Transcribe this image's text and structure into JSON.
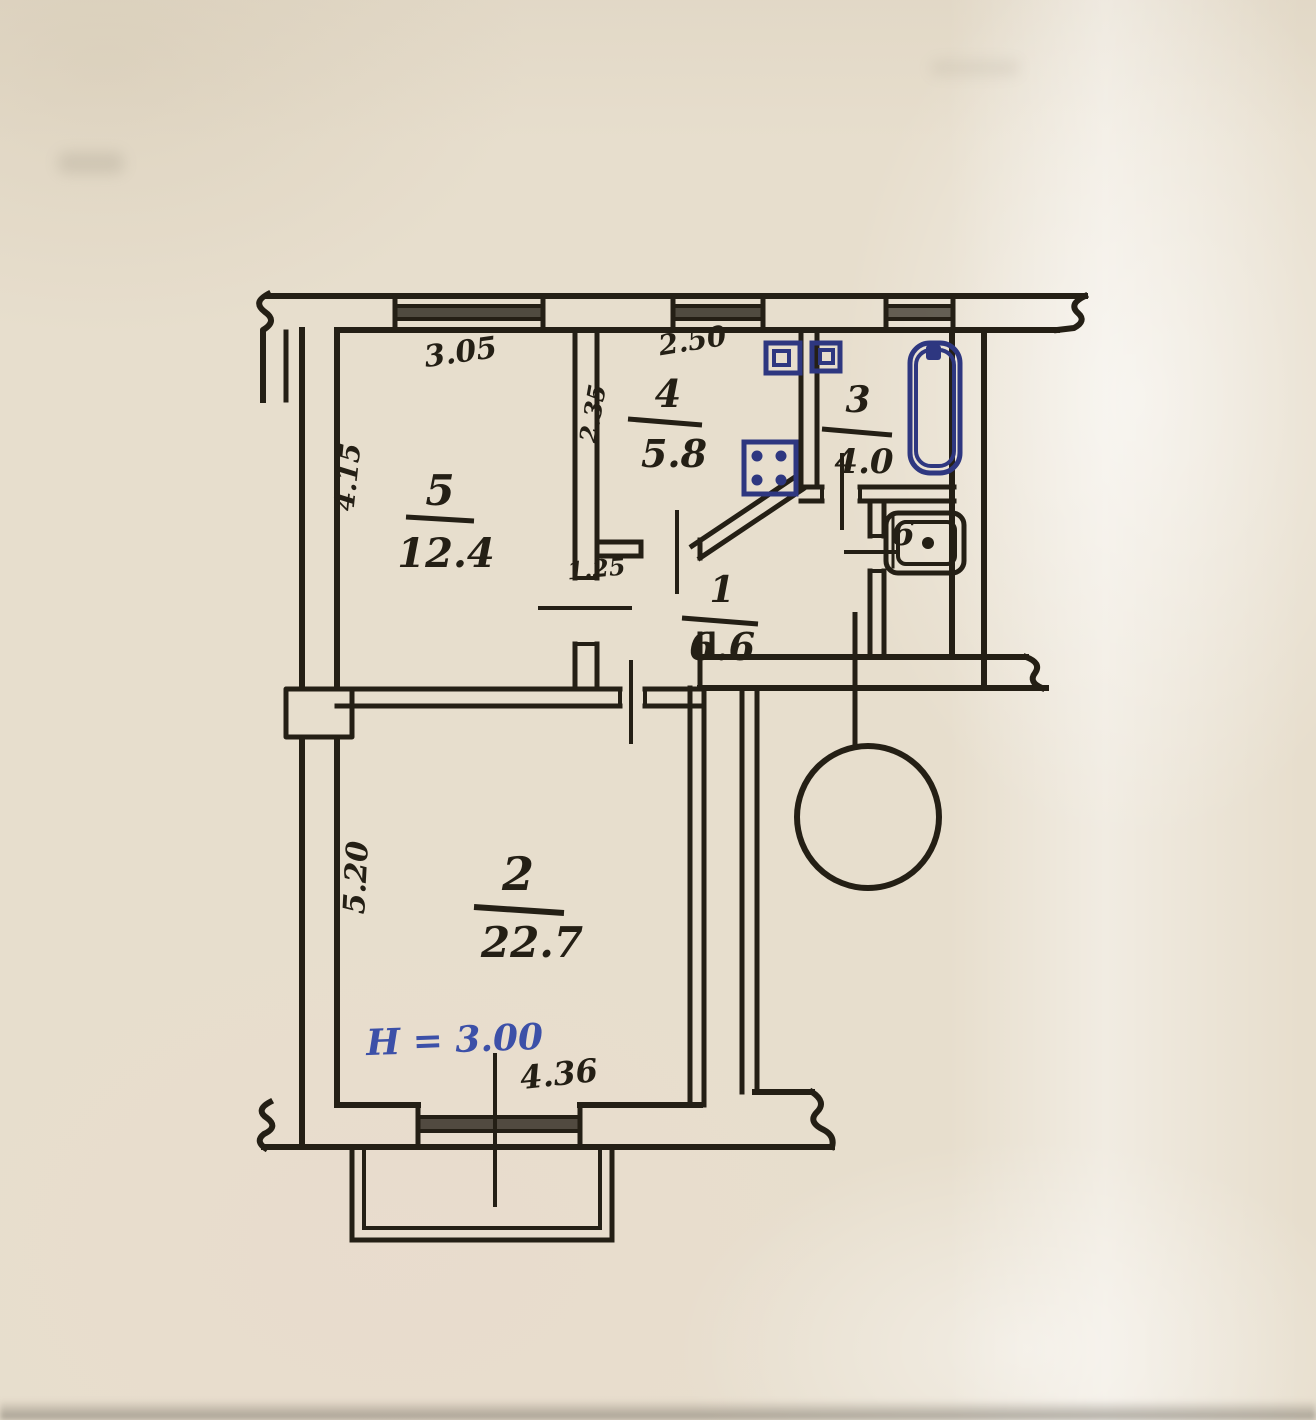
{
  "plan": {
    "rooms": {
      "r1": {
        "number": "1",
        "area": "6.6"
      },
      "r2": {
        "number": "2",
        "area": "22.7"
      },
      "r3": {
        "number": "3",
        "area": "4.0"
      },
      "r4": {
        "number": "4",
        "area": "5.8"
      },
      "r5": {
        "number": "5",
        "area": "12.4"
      },
      "r6": {
        "number": "6"
      }
    },
    "dimensions": {
      "room5_top_width": "3.05",
      "room4_top_width": "2.50",
      "room5_left_depth": "4.15",
      "room4_left_depth": "2.35",
      "hall_width": "1.25",
      "room2_left_depth": "5.20",
      "room2_bottom_width": "4.36",
      "ceiling_height": "Н = 3.00"
    },
    "colors": {
      "ink": "#241f15",
      "fixture_blue": "#2e3780",
      "annotation_blue": "#3c50a8",
      "paper": "#e7decd"
    }
  }
}
